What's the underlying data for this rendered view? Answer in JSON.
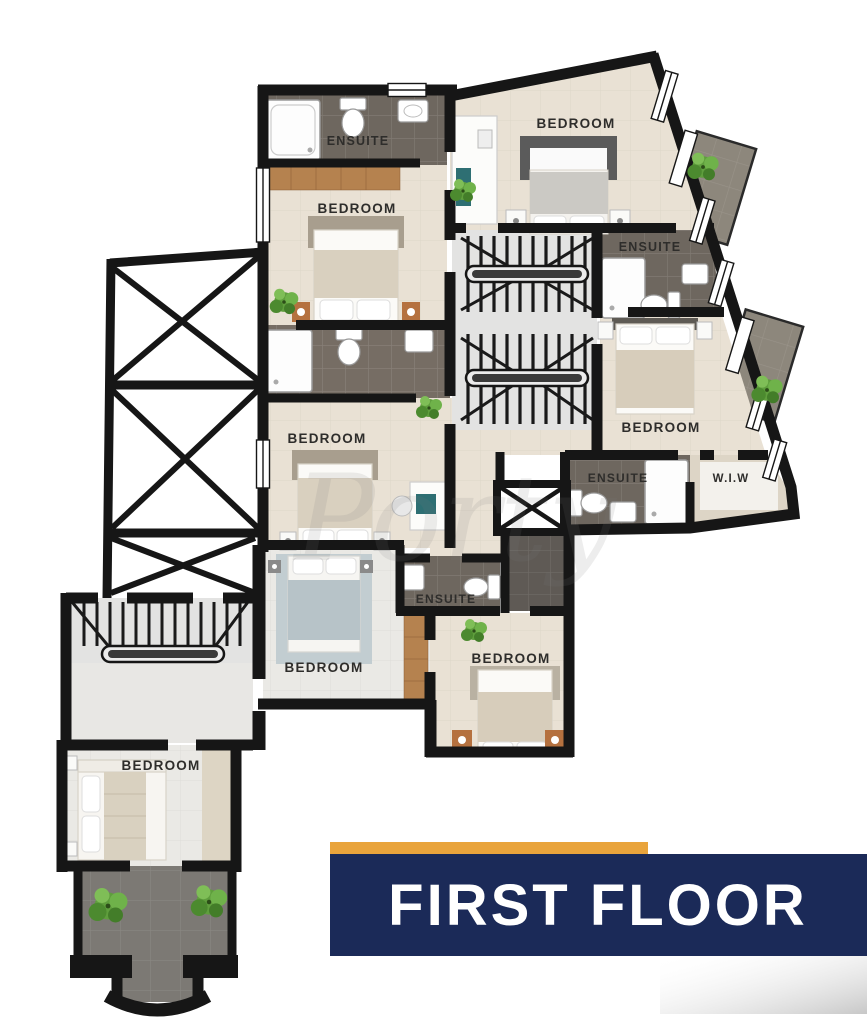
{
  "banner": {
    "label": "FIRST FLOOR",
    "navy": "#1b2a58",
    "orange": "#e9a43c"
  },
  "watermark": "Porty",
  "rooms": {
    "ensuite_top_left": "ENSUITE",
    "bedroom_top_left": "BEDROOM",
    "bedroom_top_right": "BEDROOM",
    "ensuite_top_right": "ENSUITE",
    "bedroom_mid_left": "BEDROOM",
    "bedroom_mid_right": "BEDROOM",
    "ensuite_mid_right": "ENSUITE",
    "walk_in_wardrobe": "W.I.W",
    "ensuite_bottom_center": "ENSUITE",
    "bedroom_bottom_center": "BEDROOM",
    "bedroom_bottom_right": "BEDROOM",
    "bedroom_bottom_left": "BEDROOM"
  },
  "colors": {
    "wall": "#161616",
    "floor_beige": "#e9e1d4",
    "floor_light": "#eae9e5",
    "tile_dark": "#6e675f",
    "tile_darker": "#5f5a55",
    "stairs_bg": "#e3e3e2",
    "terrace": "#7c7974",
    "balcony": "#8d877c",
    "wood": "#b5824f",
    "plant_green": "#5f9e3d",
    "blue_rug": "#b7c3c8"
  }
}
